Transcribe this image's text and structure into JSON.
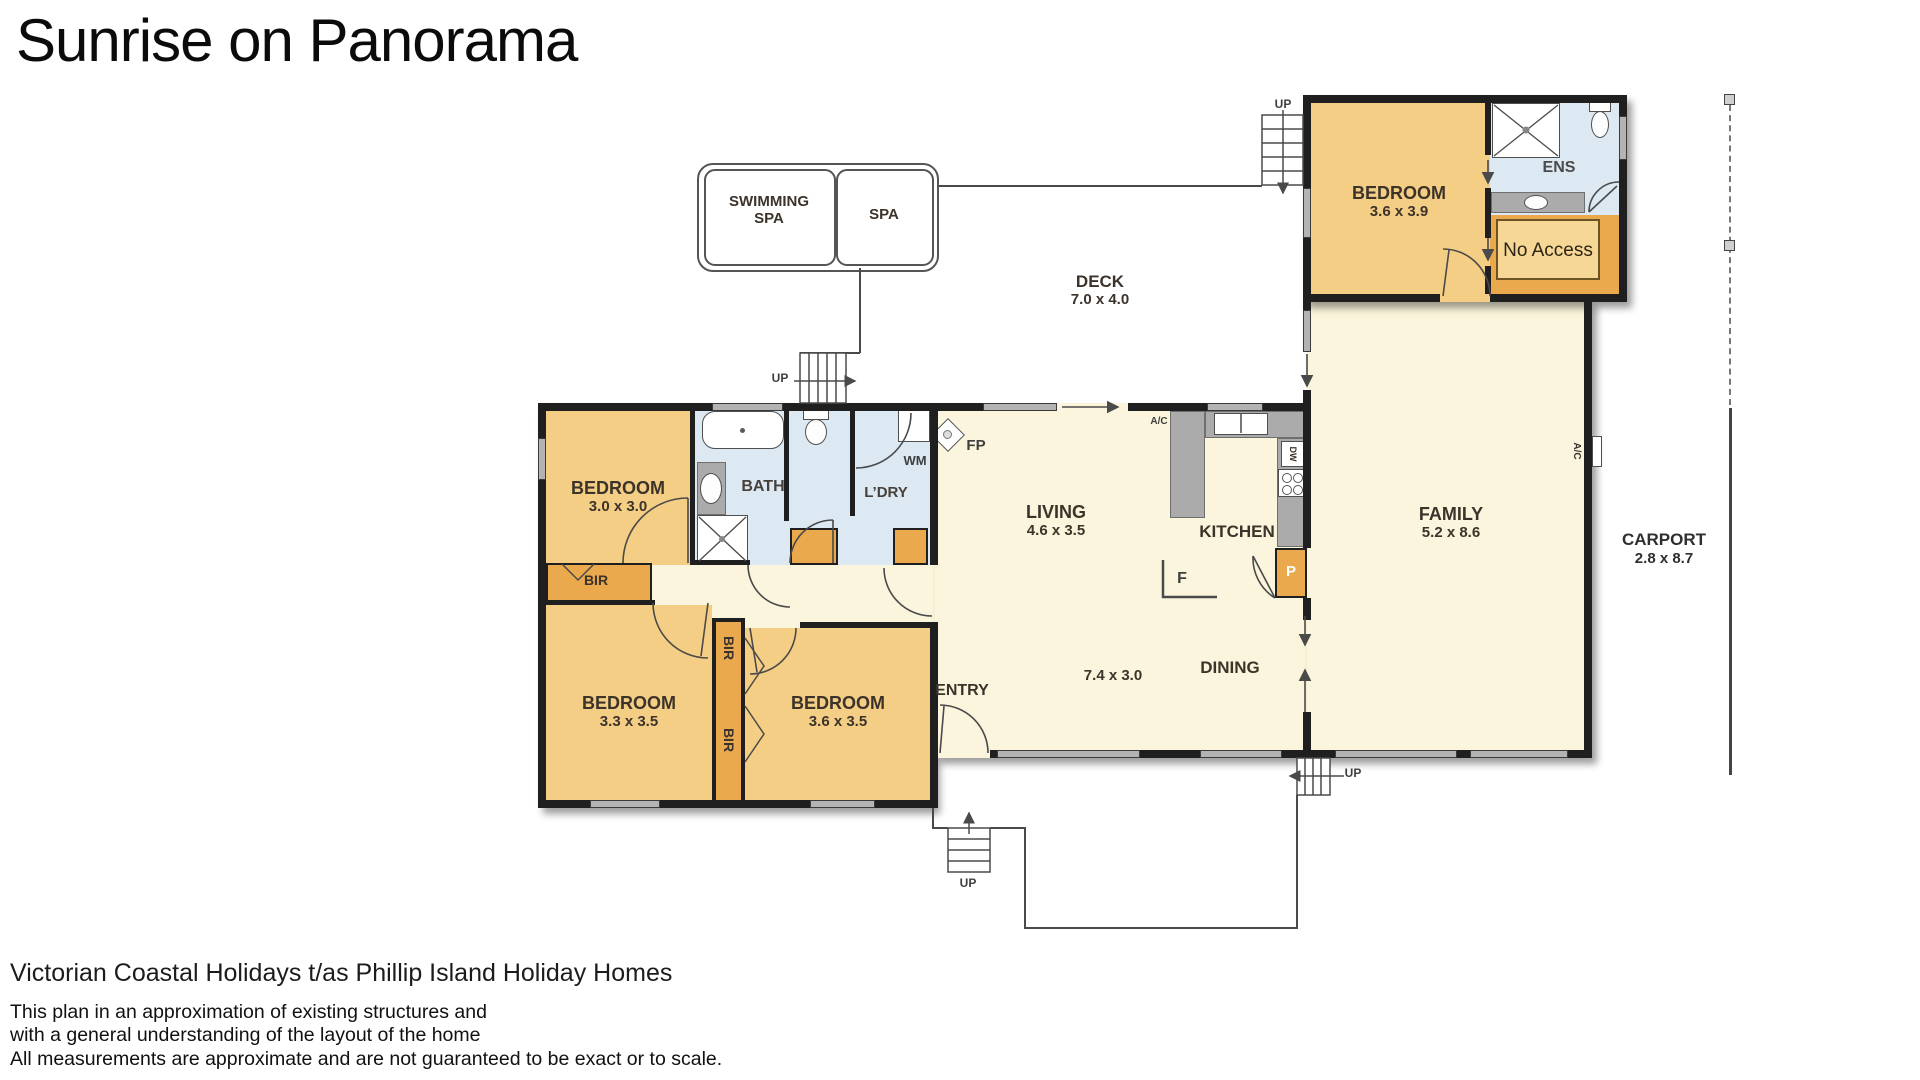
{
  "title": "Sunrise on Panorama",
  "plan": {
    "spa_area": {
      "swimming_spa": "SWIMMING SPA",
      "spa": "SPA"
    },
    "deck": {
      "name": "DECK",
      "dims": "7.0 x 4.0"
    },
    "rooms": {
      "bedroom_ens": {
        "name": "BEDROOM",
        "dims": "3.6 x 3.9"
      },
      "ens": {
        "name": "ENS"
      },
      "no_access": {
        "label": "No Access"
      },
      "bedroom_30": {
        "name": "BEDROOM",
        "dims": "3.0 x 3.0"
      },
      "bath": {
        "name": "BATH"
      },
      "laundry": {
        "name": "L’DRY"
      },
      "living": {
        "name": "LIVING",
        "dims": "4.6 x 3.5"
      },
      "kitchen": {
        "name": "KITCHEN"
      },
      "family": {
        "name": "FAMILY",
        "dims": "5.2 x 8.6"
      },
      "carport": {
        "name": "CARPORT",
        "dims": "2.8 x 8.7"
      },
      "bedroom_33": {
        "name": "BEDROOM",
        "dims": "3.3 x 3.5"
      },
      "bedroom_36": {
        "name": "BEDROOM",
        "dims": "3.6 x 3.5"
      },
      "living_dining": {
        "dims": "7.4 x 3.0"
      },
      "dining": {
        "name": "DINING"
      },
      "entry": {
        "name": "ENTRY"
      }
    },
    "fixtures": {
      "wm": "WM",
      "fp": "FP",
      "dw": "DW",
      "fridge": "F",
      "pantry": "P",
      "ac": "A/C",
      "bir": "BIR",
      "up": "UP"
    }
  },
  "footer": {
    "heading": "Victorian Coastal Holidays t/as Phillip Island Holiday Homes",
    "line1": "This plan in an approximation of existing structures and",
    "line2": "with a general understanding of the layout of the home",
    "line3": "All measurements are approximate and are not guaranteed to be exact or to scale."
  },
  "colors": {
    "room_orange": "#f5ce85",
    "robe_orange": "#e9a94c",
    "floor_cream": "#faf5dc",
    "wet_blue": "#dce8f2",
    "counter_gray": "#ababab",
    "wall_black": "#1f1f1f"
  }
}
